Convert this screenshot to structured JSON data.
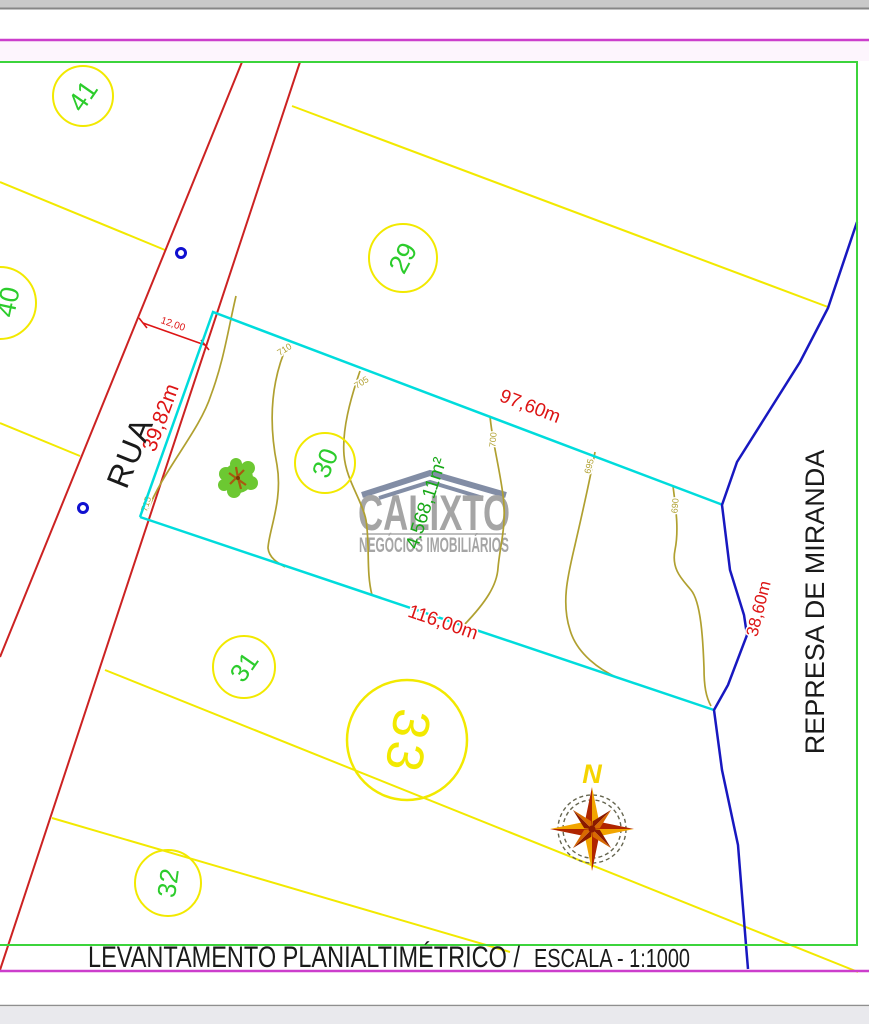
{
  "sheet": {
    "title": "LEVANTAMENTO PLANIALTIMÉTRICO /",
    "scale_label": "ESCALA - 1:1000"
  },
  "watermark": {
    "brand": "CALIXTO",
    "tagline": "NEGÓCIOS IMOBILIÁRIOS"
  },
  "map": {
    "street_label": "RUA",
    "water_label": "REPRESA DE MIRANDA",
    "area_label": "4.568,11m²",
    "compass_north": "N",
    "lots": [
      {
        "id": "41",
        "label": "41"
      },
      {
        "id": "40",
        "label": "40"
      },
      {
        "id": "29",
        "label": "29"
      },
      {
        "id": "30",
        "label": "30"
      },
      {
        "id": "31",
        "label": "31"
      },
      {
        "id": "32",
        "label": "32"
      },
      {
        "id": "33",
        "label": "33"
      }
    ],
    "dimensions": {
      "street_width": "12,00",
      "front": "39,82m",
      "rear": "97,60m",
      "bottom": "116,00m",
      "river_frontage": "38,60m"
    },
    "contours": [
      "715",
      "710",
      "705",
      "700",
      "695",
      "690"
    ]
  },
  "colors": {
    "frame_green": "#3cd43c",
    "border_magenta": "#cc3ecc",
    "street_red": "#cc2222",
    "dimension_red": "#dd1414",
    "lot_yellow": "#f2e900",
    "lot_number_green": "#2ccc2c",
    "survey_cyan": "#00dcdc",
    "contour_olive": "#b0a030",
    "river_blue": "#1818c0",
    "watermark_gray": "#969696",
    "compass_gold": "#f2a500",
    "compass_red": "#b02500",
    "tree_green": "#6cc832"
  }
}
